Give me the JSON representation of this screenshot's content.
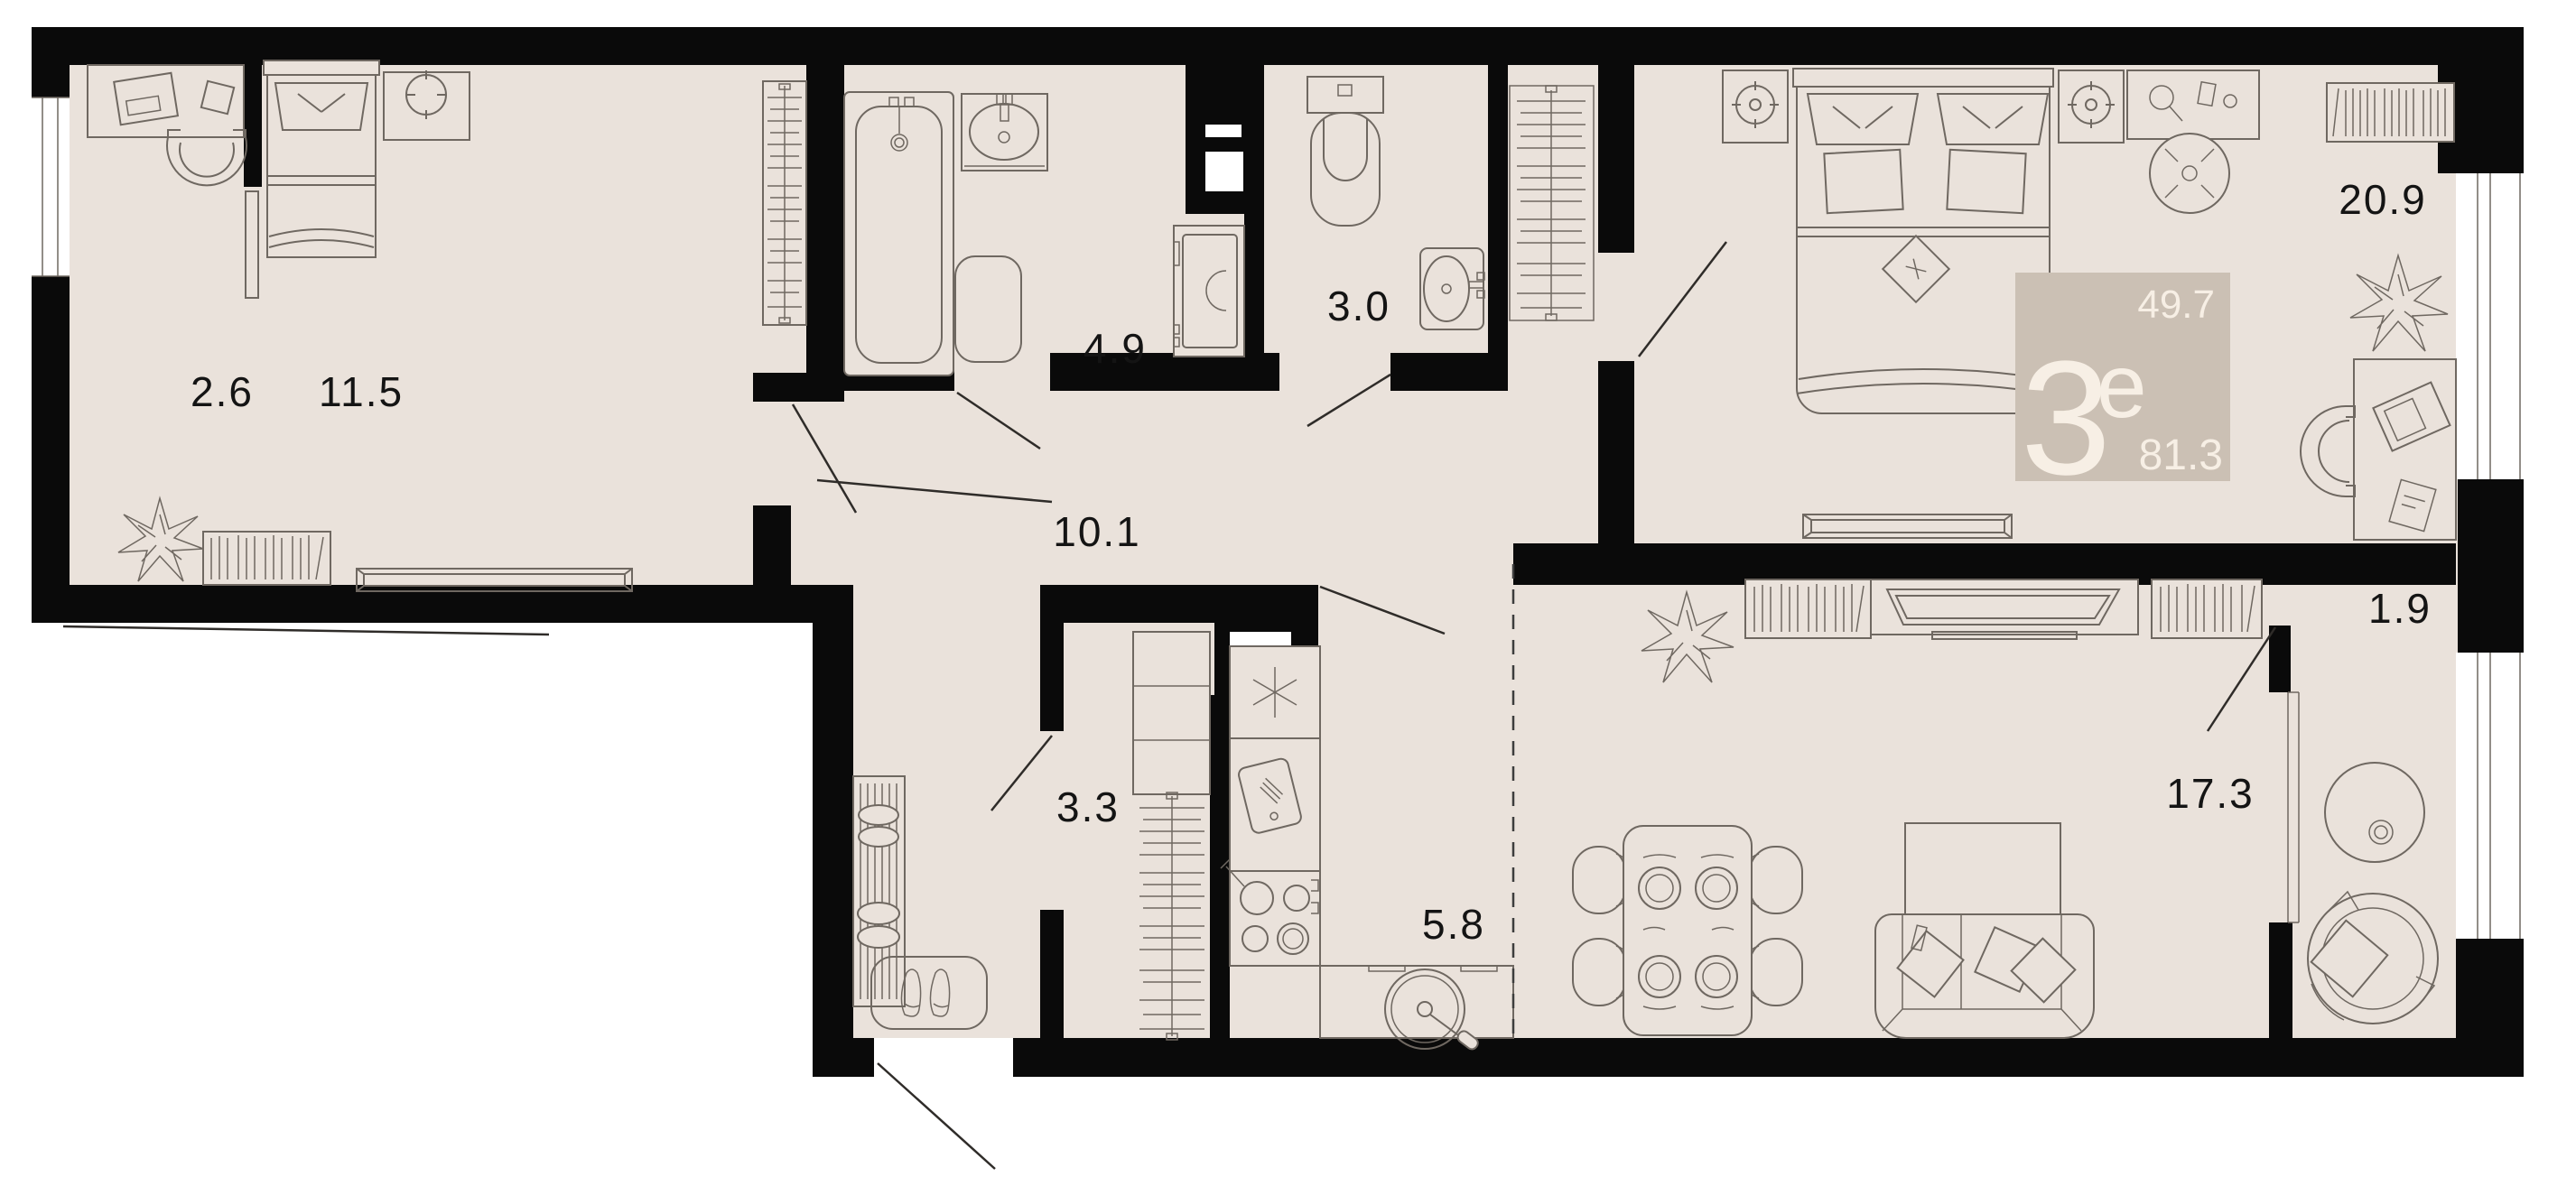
{
  "plan": {
    "unit_badge": {
      "rooms_digit": "3",
      "rooms_suffix": "е",
      "area_upper": "49.7",
      "area_total": "81.3"
    },
    "room_labels": {
      "hall_nook": "2.6",
      "bedroom_small": "11.5",
      "bathroom": "4.9",
      "wc": "3.0",
      "hallway": "10.1",
      "wardrobe_room": "3.3",
      "kitchen": "5.8",
      "bedroom_master": "20.9",
      "balcony": "1.9",
      "living_room": "17.3"
    }
  },
  "colors": {
    "floor": "#eae2db",
    "wall": "#0a0a0a",
    "furniture_line": "#6f6861",
    "label_text": "#141414",
    "badge_background": "#cbc0b4",
    "badge_text": "#f7efe5"
  }
}
